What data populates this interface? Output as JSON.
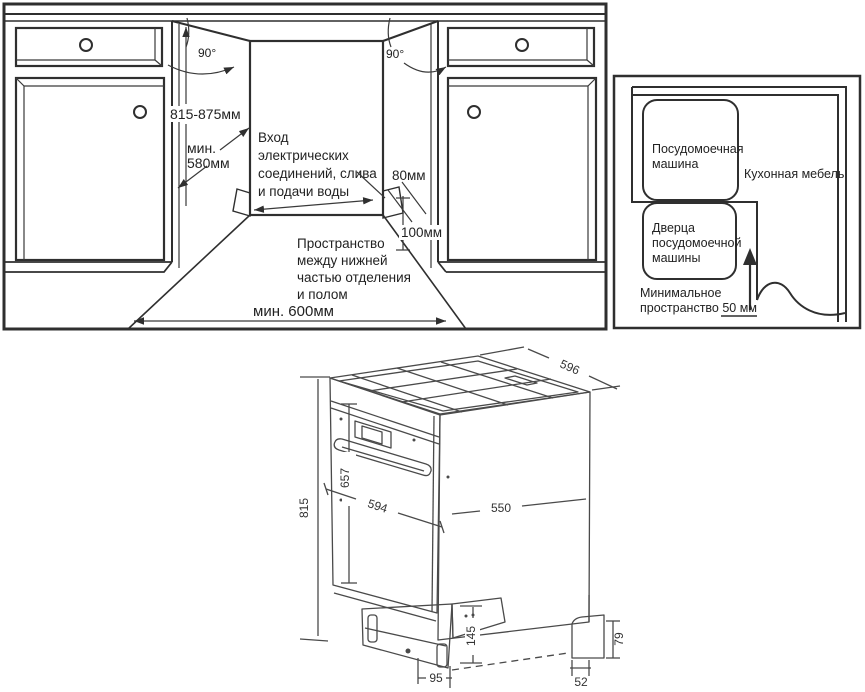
{
  "colors": {
    "line": "#2f2f2f",
    "grey_fill": "#c6c6c6",
    "background": "#ffffff"
  },
  "niche_view": {
    "angle_left": "90°",
    "angle_right": "90°",
    "height_range": "815-875мм",
    "min_depth_l1": "мин.",
    "min_depth_l2": "580мм",
    "inlet_l1": "Вход",
    "inlet_l2": "электрических",
    "inlet_l3": "соединений, слива",
    "inlet_l4": "и подачи воды",
    "inlet_width": "80мм",
    "inlet_height": "100мм",
    "gap_l1": "Пространство",
    "gap_l2": "между нижней",
    "gap_l3": "частью отделения",
    "gap_l4": "и полом",
    "min_width": "мин. 600мм"
  },
  "top_view": {
    "dw_l1": "Посудомоечная",
    "dw_l2": "машина",
    "furniture": "Кухонная мебель",
    "door_l1": "Дверца",
    "door_l2": "посудомоечной",
    "door_l3": "машины",
    "space_l1": "Минимальное",
    "space_l2": "пространство 50 мм",
    "space_value": "50 мм"
  },
  "dishwasher_view": {
    "dim_top_width": "596",
    "dim_height": "815",
    "dim_front_height": "657",
    "dim_front_width": "594",
    "dim_side_depth": "550",
    "dim_base_height": "145",
    "dim_base_inset": "95",
    "dim_foot_width": "52",
    "dim_foot_height": "79"
  }
}
